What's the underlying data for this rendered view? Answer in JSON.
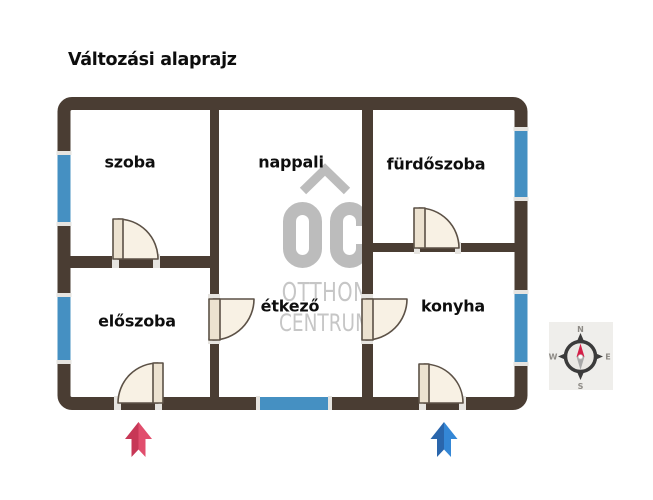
{
  "title": {
    "text": "Változási alaprajz"
  },
  "rooms": [
    {
      "name": "szoba"
    },
    {
      "name": "nappali"
    },
    {
      "name": "fürdőszoba"
    },
    {
      "name": "előszoba"
    },
    {
      "name": "étkező"
    },
    {
      "name": "konyha"
    }
  ],
  "watermark": {
    "initials": "OC",
    "line1": "OTTHON",
    "line2": "CENTRUM"
  },
  "compass": {
    "north": "N",
    "east": "E",
    "south": "S",
    "west": "W"
  },
  "colors": {
    "wall": "#4a3d33",
    "window": "#4590c2",
    "window_cap": "#e6e4e0",
    "door_fill": "#f8f1e4",
    "door_leaf": "#ece2d0",
    "door_outline": "#5c5146",
    "watermark": "#bcbcbc",
    "watermark_text": "#c6c6c6",
    "arrow_red_dark": "#c73756",
    "arrow_red_light": "#e14e6d",
    "arrow_blue_dark": "#2a66ac",
    "arrow_blue_light": "#3487d6",
    "compass_ring": "#3b3b3b",
    "compass_needle_red": "#d41f47",
    "compass_needle_gray": "#a8a8a8",
    "compass_letter": "#8e8b86"
  }
}
